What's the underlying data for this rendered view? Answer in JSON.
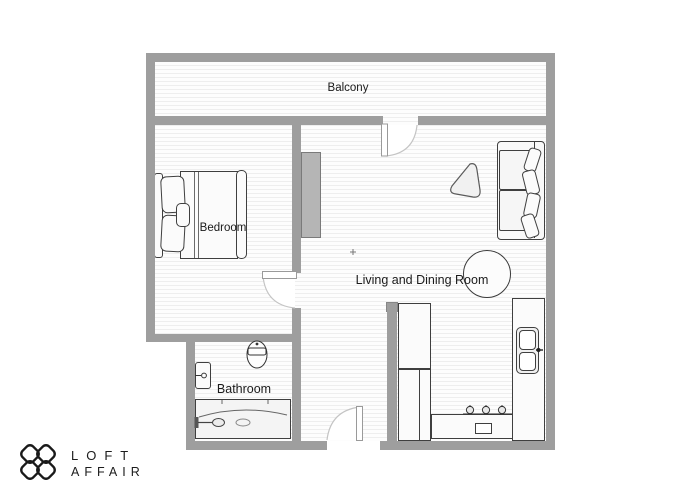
{
  "brand": {
    "name_line1": "LOFT",
    "name_line2": "AFFAIR"
  },
  "rooms": {
    "balcony": {
      "label": "Balcony",
      "furniture": []
    },
    "bedroom": {
      "label": "Bedroom",
      "furniture": [
        "double-bed",
        "headboard",
        "pillows"
      ]
    },
    "living_dining": {
      "label": "Living and Dining Room",
      "furniture": [
        "sofa",
        "coffee-table",
        "round-dining-table",
        "tv-cabinet",
        "kitchen-counter-left",
        "kitchen-counter-right",
        "kitchen-island-oven",
        "cooktop-burners",
        "double-kitchen-sink"
      ]
    },
    "bathroom": {
      "label": "Bathroom",
      "furniture": [
        "toilet",
        "wash-basin",
        "bathtub"
      ]
    }
  },
  "doors": [
    "balcony-door",
    "bedroom-door",
    "entrance-door"
  ],
  "colors": {
    "wall": "#9e9e9e",
    "floor_line": "#eeeeee",
    "furniture_outline": "#3f3f3f",
    "logo": "#1a1a1a"
  },
  "marks": {
    "center_cross": "+"
  }
}
